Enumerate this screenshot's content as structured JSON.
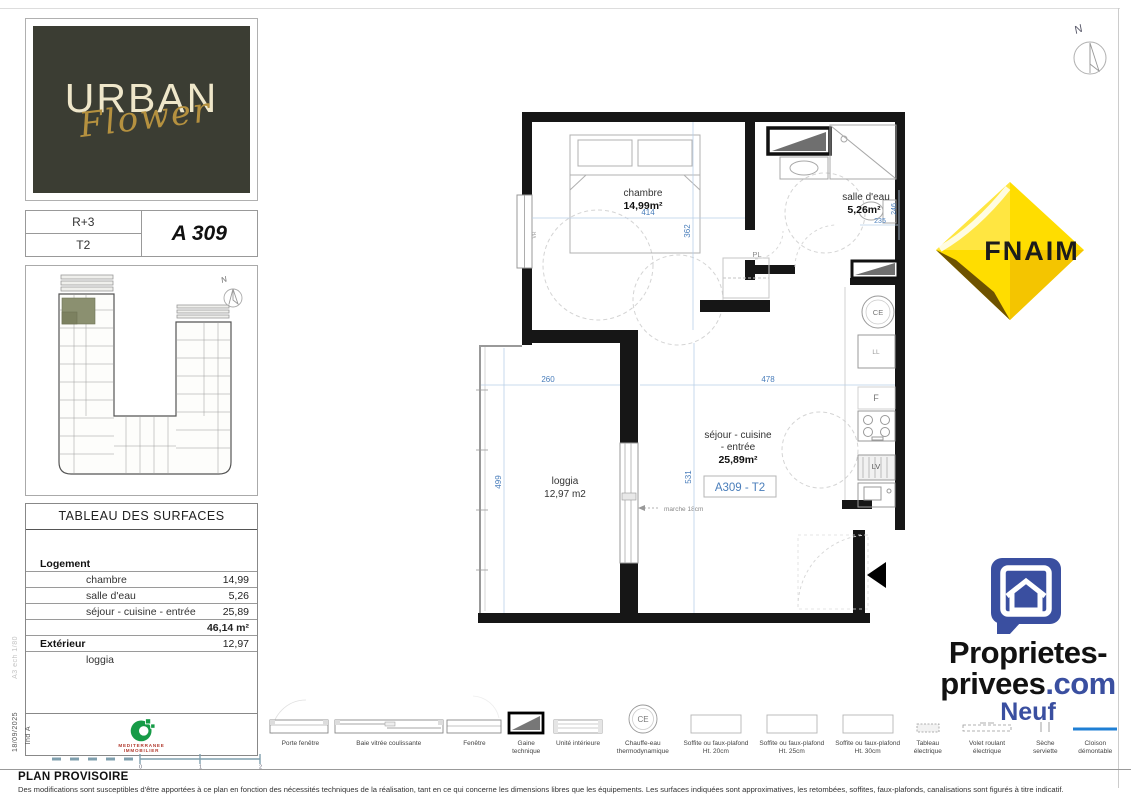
{
  "page": {
    "footer_title": "PLAN PROVISOIRE",
    "footer_disclaimer": "Des modifications sont susceptibles d'être apportées à ce plan en fonction des nécessités techniques de la réalisation, tant en ce qui concerne les dimensions libres que les équipements. Les surfaces indiquées sont approximatives, les retombées, soffites, faux-plafonds, canalisations sont figurés à titre indicatif.",
    "north": "N"
  },
  "branding": {
    "logo_line1": "URBAN",
    "logo_line2": "Flower",
    "fnaim": "FNAIM",
    "pp_line1": "Proprietes-",
    "pp_line2a": "privees",
    "pp_line2b": ".com",
    "pp_line3": "Neuf",
    "agency_line1": "MEDITERRANEE",
    "agency_line2": "IMMOBILIER"
  },
  "unit": {
    "floor": "R+3",
    "type": "T2",
    "number": "A 309"
  },
  "surfaces": {
    "title": "TABLEAU DES SURFACES",
    "logement_label": "Logement",
    "rows": [
      {
        "name": "chambre",
        "value": "14,99"
      },
      {
        "name": "salle d'eau",
        "value": "5,26"
      },
      {
        "name": "séjour - cuisine - entrée",
        "value": "25,89"
      }
    ],
    "total": "46,14 m²",
    "exterior_label": "Extérieur",
    "exterior_value": "12,97",
    "exterior_item": "loggia"
  },
  "plan": {
    "chambre_label": "chambre",
    "chambre_area": "14,99m²",
    "sde_label": "salle d'eau",
    "sde_area": "5,26m²",
    "sejour_l1": "séjour - cuisine",
    "sejour_l2": "- entrée",
    "sejour_area": "25,89m²",
    "unit_box": "A309 - T2",
    "loggia_label": "loggia",
    "loggia_area": "12,97 m2",
    "dims": {
      "w_chambre": "414",
      "h_chambre": "362",
      "h_sde": "246",
      "w_sde": "235",
      "w_loggia": "260",
      "w_sejour": "478",
      "h_loggia": "499",
      "h_sejour": "531"
    },
    "labels": {
      "pl": "PL",
      "ce": "CE",
      "ll": "LL",
      "f": "F",
      "lv": "LV",
      "step": "marche 18cm",
      "vr": "VR"
    }
  },
  "legend": {
    "items": [
      {
        "l1": "Porte fenêtre"
      },
      {
        "l1": "Baie vitrée coulissante"
      },
      {
        "l1": "Fenêtre"
      },
      {
        "l1": "Gaine",
        "l2": "technique"
      },
      {
        "l1": "Unité intérieure"
      },
      {
        "l1": "Chauffe-eau",
        "l2": "thermodynamique",
        "symbol": "CE"
      },
      {
        "l1": "Soffite ou faux-plafond",
        "l2": "Ht. 20cm"
      },
      {
        "l1": "Soffite ou faux-plafond",
        "l2": "Ht. 25cm"
      },
      {
        "l1": "Soffite ou faux-plafond",
        "l2": "Ht. 30cm"
      },
      {
        "l1": "Tableau",
        "l2": "électrique"
      },
      {
        "l1": "Volet roulant",
        "l2": "électrique"
      },
      {
        "l1": "Sèche",
        "l2": "serviette"
      },
      {
        "l1": "Cloison",
        "l2": "démontable"
      }
    ]
  },
  "meta": {
    "date": "18/09/2025",
    "index": "Ind A",
    "sheet": "A3 ech 1/80",
    "scale_ticks": [
      "0",
      "1",
      "2"
    ]
  },
  "colors": {
    "wall": "#161616",
    "dim_blue": "#4a7ebb",
    "cloison_blue": "#1f7fd4",
    "fnaim_yellow": "#ffdd00",
    "pp_blue": "#3a4fa0",
    "logo_bg": "#3b3d33",
    "gold": "#b5913f",
    "agency_green": "#169b47",
    "agency_red": "#b23a2e",
    "site_highlight": "#8b9070"
  }
}
